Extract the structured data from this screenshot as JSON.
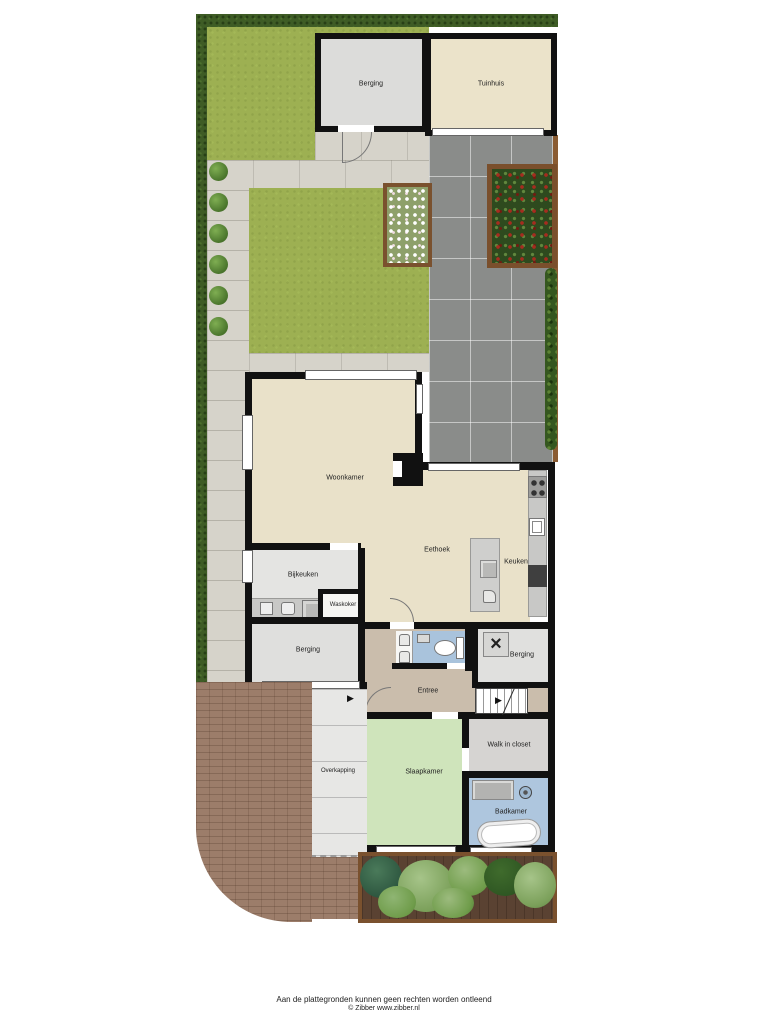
{
  "plan": {
    "rooms": {
      "berging_shed": {
        "label": "Berging"
      },
      "tuinhuis": {
        "label": "Tuinhuis"
      },
      "woonkamer": {
        "label": "Woonkamer"
      },
      "eethoek": {
        "label": "Eethoek"
      },
      "keuken": {
        "label": "Keuken"
      },
      "bijkeuken": {
        "label": "Bijkeuken"
      },
      "waskoker": {
        "label": "Waskoker"
      },
      "berging_left": {
        "label": "Berging"
      },
      "berging_right": {
        "label": "Berging"
      },
      "entree": {
        "label": "Entree"
      },
      "overkapping": {
        "label": "Overkapping"
      },
      "slaapkamer": {
        "label": "Slaapkamer"
      },
      "walk_in_closet": {
        "label": "Walk in closet"
      },
      "badkamer": {
        "label": "Badkamer"
      }
    },
    "icons": {
      "stairs_arrow": "▶",
      "entry_arrow": "▶",
      "boiler_fan": "×"
    },
    "colors": {
      "wall": "#111111",
      "living_floor": "#e9e1c9",
      "bedroom_floor": "#cfe4bb",
      "bathroom_floor": "#aec6de",
      "wc_floor": "#a9c3dc",
      "entree_floor": "#cabdac",
      "lawn": "#9db052",
      "hedge": "#3e5c25",
      "patio_tile": "#8a8c8a",
      "brick": "#9c7d6a",
      "planter_wood": "#7a512e"
    },
    "footer": {
      "disclaimer": "Aan de plattegronden kunnen geen rechten worden ontleend",
      "copyright": "© Zibber www.zibber.nl"
    }
  }
}
